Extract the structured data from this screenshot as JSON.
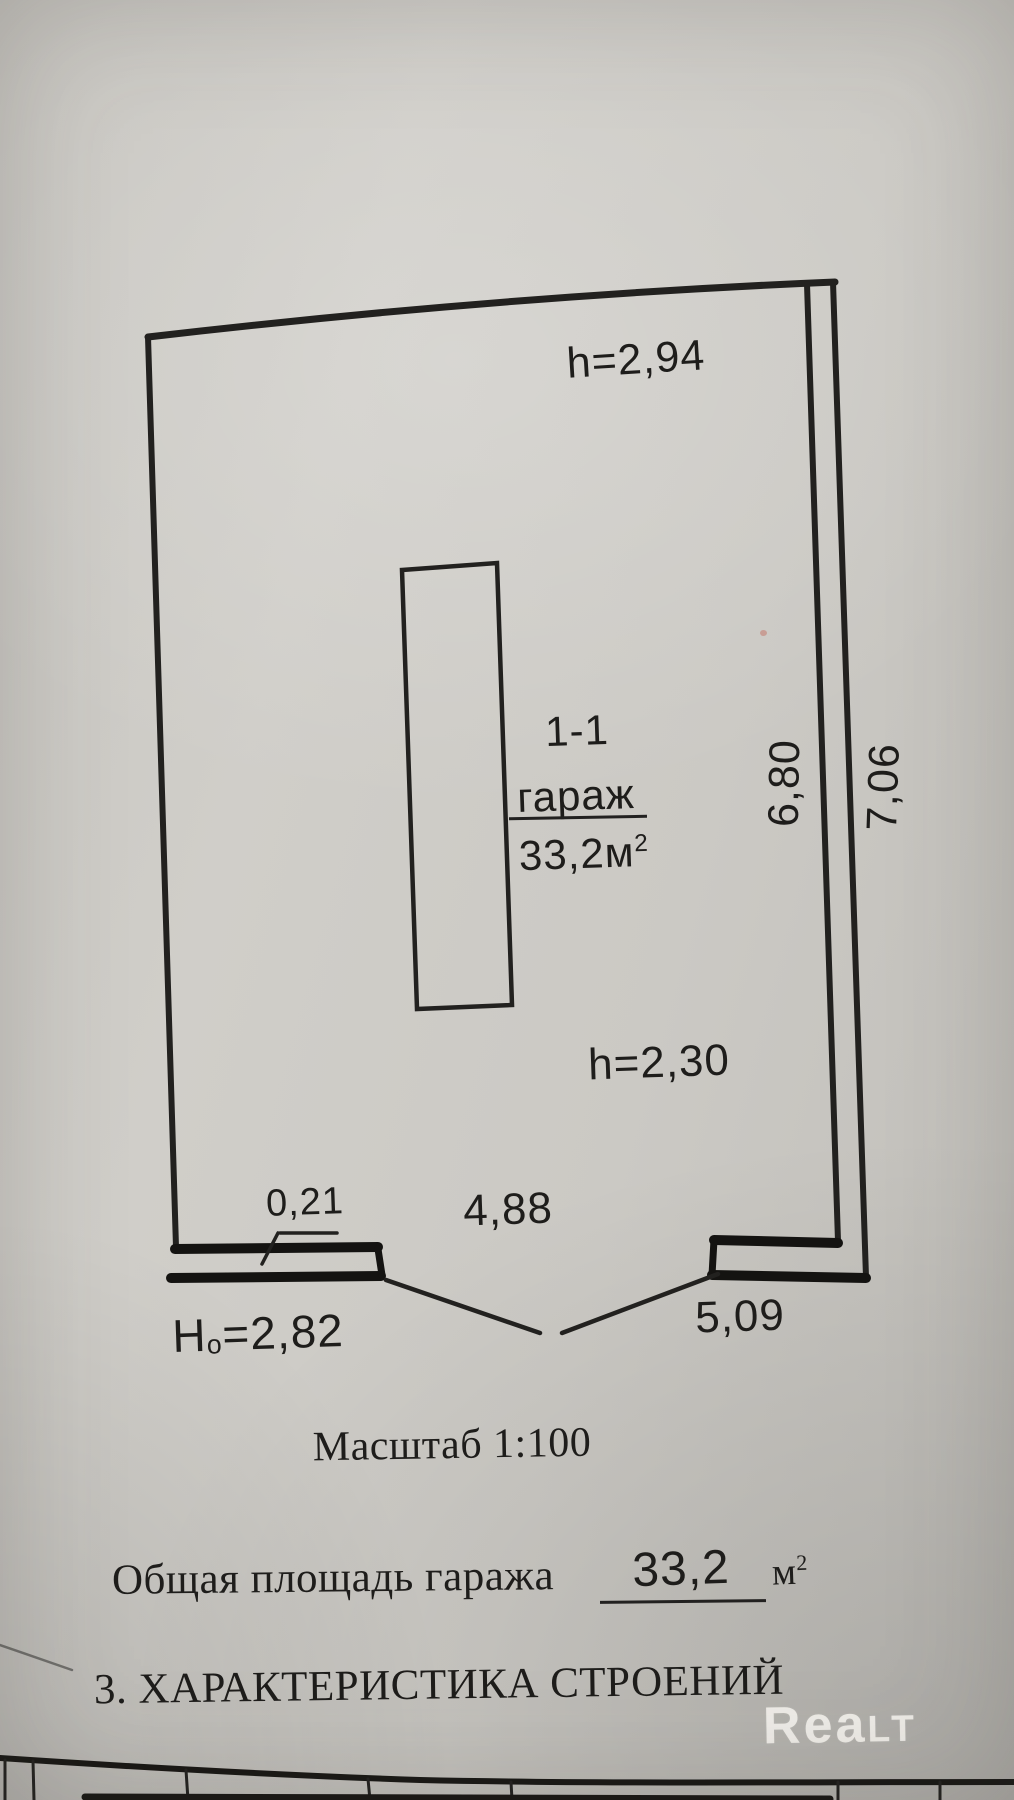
{
  "plan": {
    "ceiling_height_main": "h=2,94",
    "room_number": "1-1",
    "room_name": "гараж",
    "room_area_value": "33,2м",
    "room_area_sup": "2",
    "dim_inner_length": "6,80",
    "dim_outer_length": "7,06",
    "ceiling_height_low": "h=2,30",
    "dim_wall_thickness": "0,21",
    "dim_inner_width": "4,88",
    "dim_outer_width": "5,09",
    "gate_height_prefix": "H",
    "gate_height_sub": "о",
    "gate_height_value": "=2,82"
  },
  "scale_note": "Масштаб 1:100",
  "total_area": {
    "label": "Общая площадь гаража",
    "value": "33,2",
    "unit": "м",
    "unit_sup": "2"
  },
  "section_heading": "3. ХАРАКТЕРИСТИКА СТРОЕНИЙ",
  "watermark": {
    "main": "Rea",
    "caps": "LT"
  },
  "colors": {
    "ink": "#1e1d1b",
    "paper": "#cbc9c4",
    "watermark": "rgba(247,245,240,0.85)"
  }
}
